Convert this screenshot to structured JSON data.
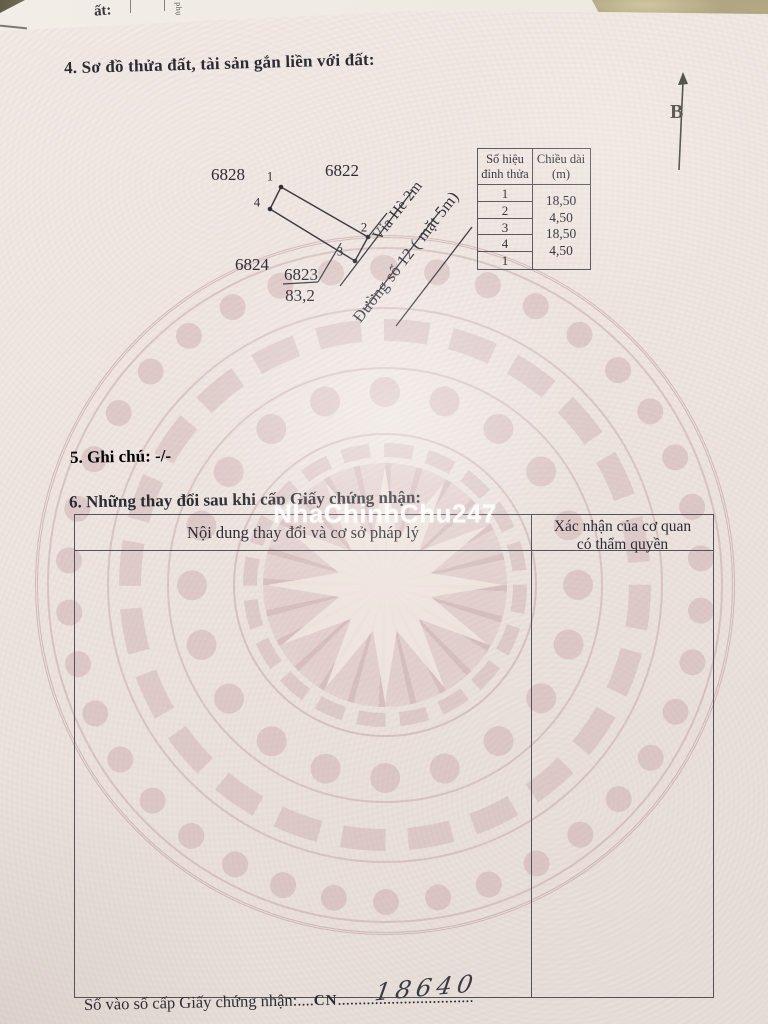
{
  "document": {
    "section4_title": "4. Sơ đồ thửa đất, tài sản gắn liền với đất:",
    "section5_label": "5. Ghi chú:",
    "section5_value": "-/-",
    "section6_title": "6. Những thay đổi sau khi cấp Giấy chứng nhận:",
    "registry": {
      "label": "Số vào sổ cấp Giấy chứng nhận:",
      "dots_a": "....",
      "cn_label": "CN",
      "dots_b": "...",
      "number_handwritten": "18640",
      "dots_c": ".............................."
    }
  },
  "diagram": {
    "north_label": "B",
    "parcel_top_left": "6828",
    "parcel_top": "6822",
    "parcel_left": "6824",
    "parcel_main": "6823",
    "area": "83,2",
    "vertex_labels": [
      "1",
      "2",
      "3",
      "4"
    ],
    "sidewalk_label": "Vỉa Hè 2m",
    "street_label": "Đường số 12 ( mặt 5m)"
  },
  "vertex_table": {
    "col1_header_line1": "Số hiệu",
    "col1_header_line2": "đỉnh thửa",
    "col2_header_line1": "Chiều dài",
    "col2_header_line2": "(m)",
    "vertex_ids": [
      "1",
      "2",
      "3",
      "4",
      "1"
    ],
    "lengths": [
      "18,50",
      "4,50",
      "18,50",
      "4,50"
    ]
  },
  "changes_table": {
    "col1_header": "Nội dung thay đổi và cơ sở pháp lý",
    "col2_header_line1": "Xác nhận của cơ quan",
    "col2_header_line2": "có thẩm quyền"
  },
  "watermark": {
    "text": "NhaChinhChu247"
  },
  "back_sheet": {
    "partial_text": "ất:",
    "edge_text": "phụ"
  },
  "colors": {
    "paper": "#efe7e2",
    "drum_pink": "#c8a9ad",
    "ink": "#2b2b33",
    "table_border": "#53525a",
    "desk": "#a39876",
    "watermark_text": "#ffffff"
  }
}
